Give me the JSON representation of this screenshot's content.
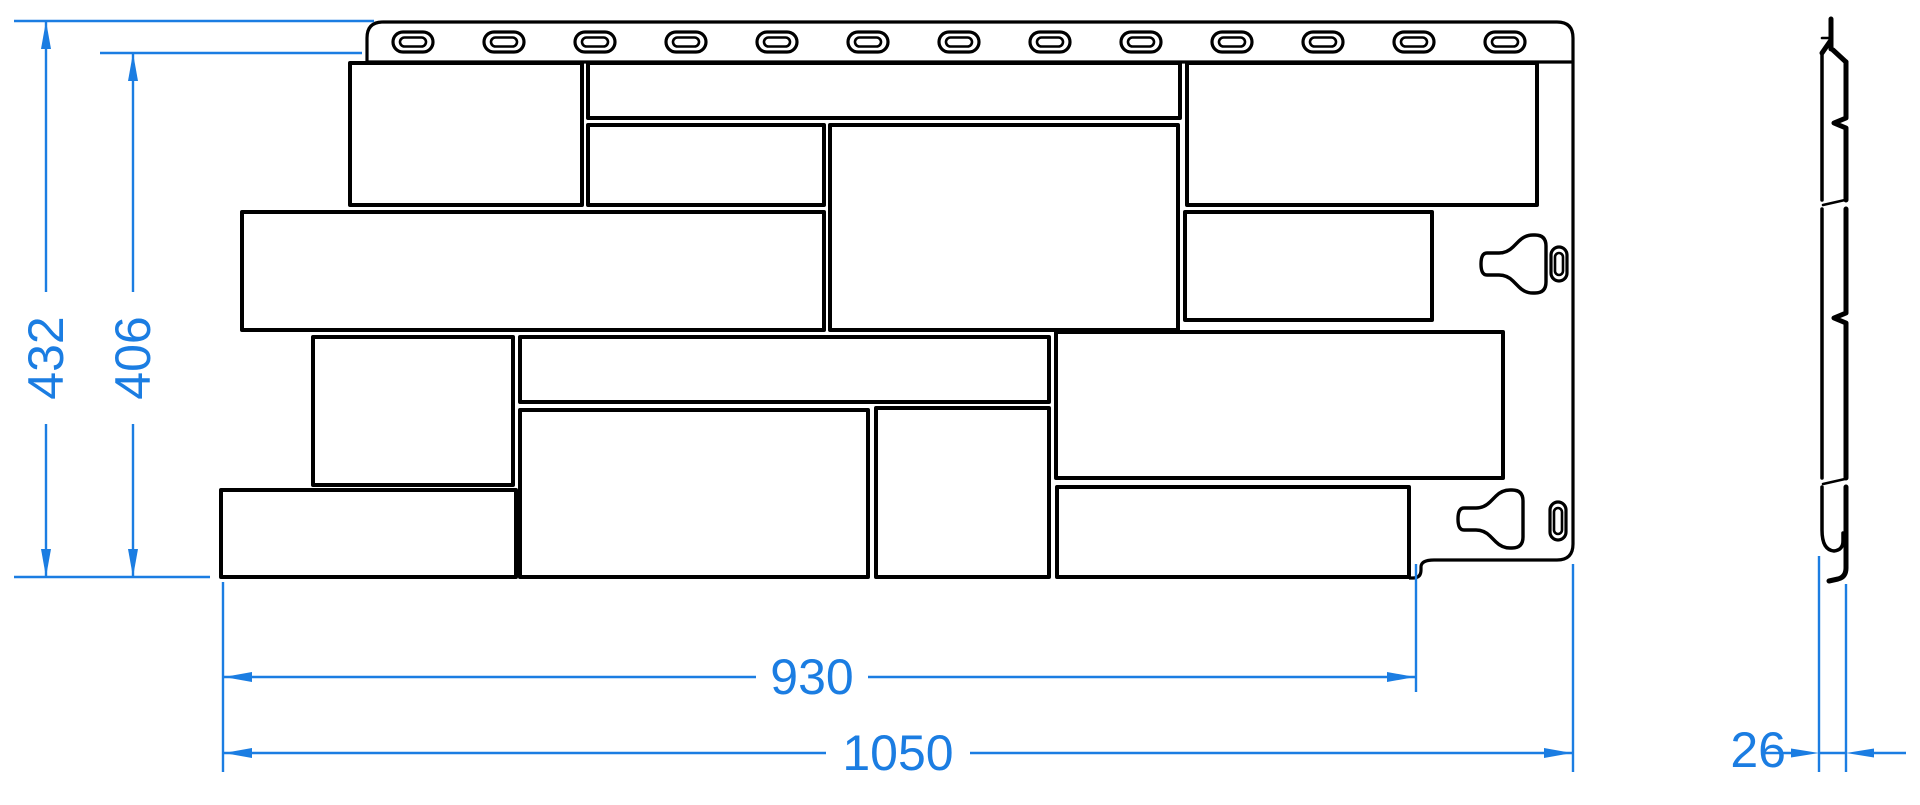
{
  "drawing": {
    "kind": "facade-panel-technical-drawing",
    "views": {
      "front_view": {
        "nail_slot_count": 13,
        "stone_block_count": 14,
        "fastener_tab_count": 2,
        "fastener_slot_count": 2
      },
      "side_view": {
        "description": "panel edge profile with top hem and bottom J-hook"
      }
    }
  },
  "dimensions": {
    "overall_height": {
      "value": "432",
      "orientation": "vertical"
    },
    "stone_field_height": {
      "value": "406",
      "orientation": "vertical"
    },
    "stone_field_width": {
      "value": "930",
      "orientation": "horizontal"
    },
    "overall_width": {
      "value": "1050",
      "orientation": "horizontal"
    },
    "thickness": {
      "value": "26",
      "orientation": "horizontal"
    }
  },
  "colors": {
    "dimension_blue": "#1b7de2",
    "line_black": "#000000",
    "background": "#ffffff"
  }
}
